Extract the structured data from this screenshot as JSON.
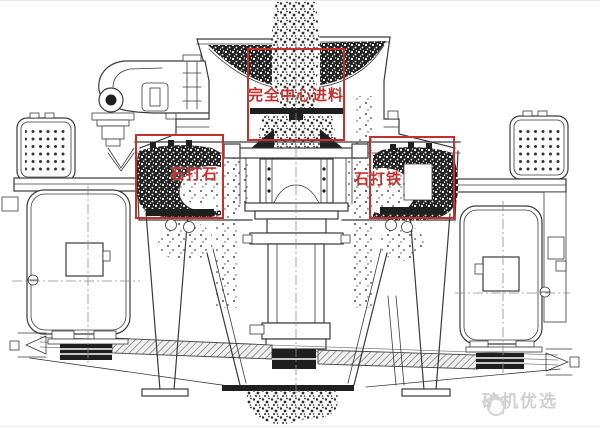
{
  "annotations": {
    "center_feed": {
      "label": "完全中心进料"
    },
    "stone_on_stone": {
      "label": "石打石"
    },
    "stone_on_iron": {
      "label": "石打铁"
    }
  },
  "watermark": {
    "text": "矿机优选",
    "icon": "swoosh-circle-logo-icon"
  },
  "colors": {
    "annotation_red": "#c4302b",
    "drawing_line": "#3a3a3a",
    "watermark_gray": "#d0d0d0",
    "background": "#ffffff"
  }
}
